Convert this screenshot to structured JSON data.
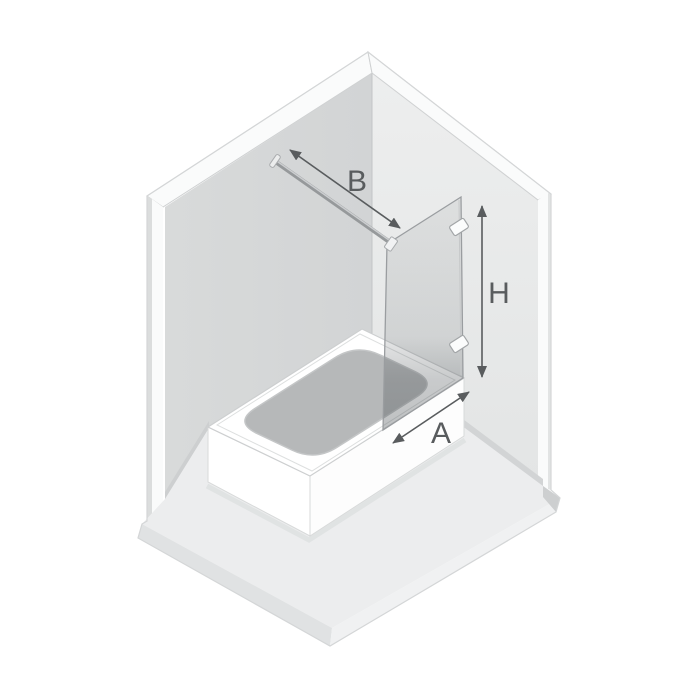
{
  "diagram": {
    "scene": "isometric bathroom corner with bathtub and walk-in glass screen",
    "dimension_labels": {
      "bar": "B",
      "height": "H",
      "width": "A"
    },
    "elements": {
      "left_wall": "left wall",
      "right_wall": "right wall",
      "floor": "floor slab",
      "bathtub": "bathtub",
      "basin": "bathtub basin",
      "glass_panel": "glass screen panel",
      "support_bar": "wall support bar",
      "brackets": "wall mounting brackets"
    },
    "colors": {
      "background": "#ffffff",
      "left_wall": "#d5d7d8",
      "right_wall": "#e9eaea",
      "floor": "#ecedee",
      "trim": "#fafbfb",
      "slab_left_face": "#e0e2e3",
      "slab_right_face": "#f0f1f2",
      "bathtub": "#ffffff",
      "basin": "#b6b8b9",
      "glass_tint": "#4b5155",
      "dimension_line": "#595c5e",
      "support_bar": "#96999b"
    }
  }
}
